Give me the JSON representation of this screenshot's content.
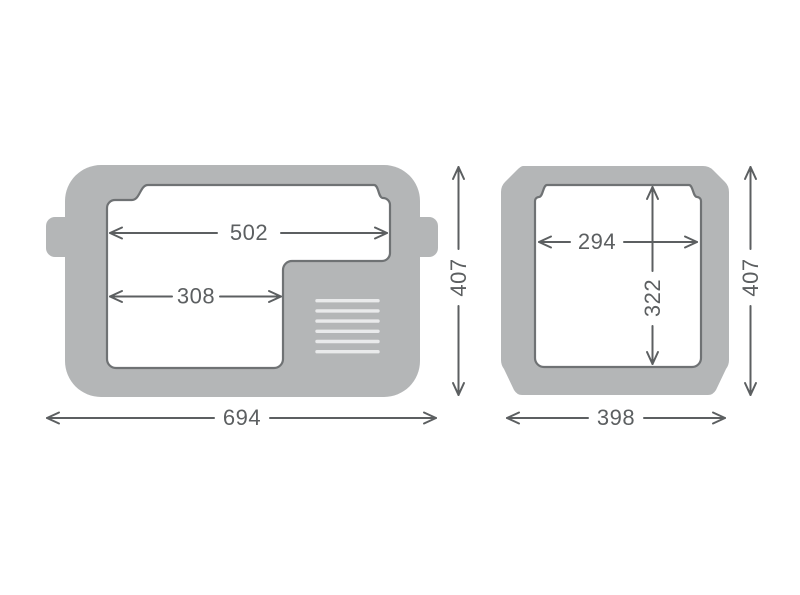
{
  "diagram": {
    "colors": {
      "body": "#b4b6b7",
      "interior_stroke": "#6f7274",
      "dimension": "#5c5f61",
      "vent": "#e9eaeb",
      "background": "#ffffff"
    },
    "side_view": {
      "interior_width_top": "502",
      "interior_width_front": "308",
      "overall_width": "694",
      "overall_height": "407"
    },
    "front_view": {
      "interior_width": "294",
      "interior_depth": "322",
      "overall_width": "398",
      "overall_height": "407"
    }
  }
}
